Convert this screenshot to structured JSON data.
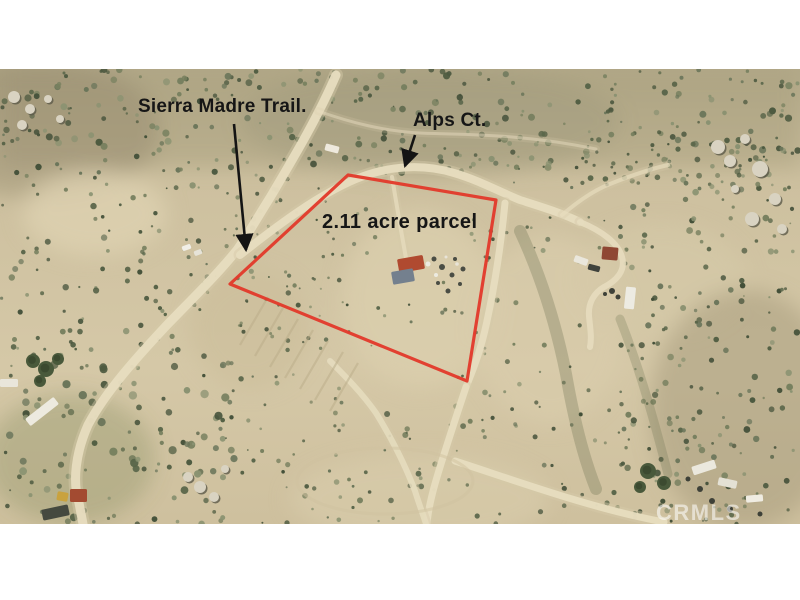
{
  "annotations": {
    "sierra_madre_trail": "Sierra Madre Trail.",
    "alps_ct": "Alps Ct.",
    "parcel": "2.11 acre parcel",
    "watermark": "CRMLS"
  },
  "colors": {
    "boundary": "#e23a2c",
    "annotation_text": "#161616",
    "watermark": "rgba(255,255,255,0.55)",
    "frame": "#ffffff"
  }
}
